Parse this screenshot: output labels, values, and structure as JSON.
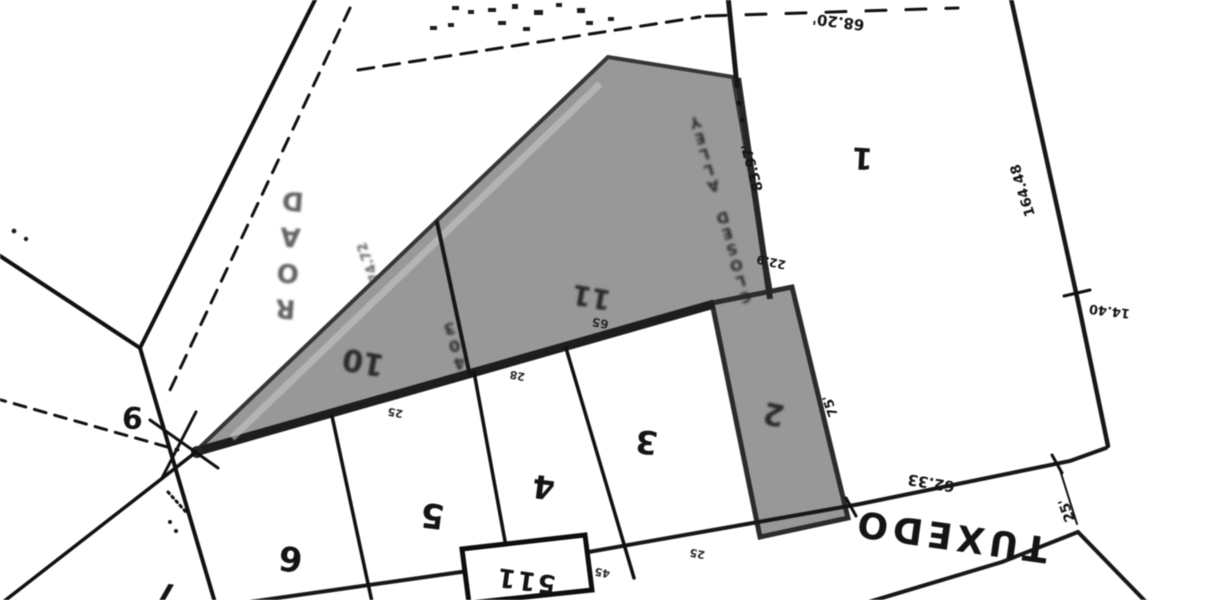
{
  "map": {
    "streets": {
      "tuxedo": "TUXEDO",
      "road": "ROAD"
    },
    "lots": {
      "lot1": "1",
      "lot2": "2",
      "lot3": "3",
      "lot4": "4",
      "lot5": "5",
      "lot6": "6",
      "lot7": "7",
      "lot9": "9",
      "lot10": "10",
      "lot11": "11"
    },
    "house_number": "511",
    "annotations": {
      "closed_alley": "CLOSED ALLEY",
      "alley_number": "403"
    },
    "dimensions": {
      "lot1_top": "68.20'",
      "alley_east": "83.97'",
      "alley_jog": "22.9",
      "east_line": "164.48",
      "corner_offset": "14.40",
      "cross_street_width": "25'",
      "street_frontage": "62.33",
      "lot2_east": "75'",
      "road_frontage": "74.72",
      "gray_edge": "65",
      "tick_a": "25",
      "tick_b": "28",
      "tick_c": "45",
      "tick_d": "25"
    },
    "colors": {
      "paper": "#ffffff",
      "ink": "#141414",
      "highlight": "#979797"
    }
  }
}
